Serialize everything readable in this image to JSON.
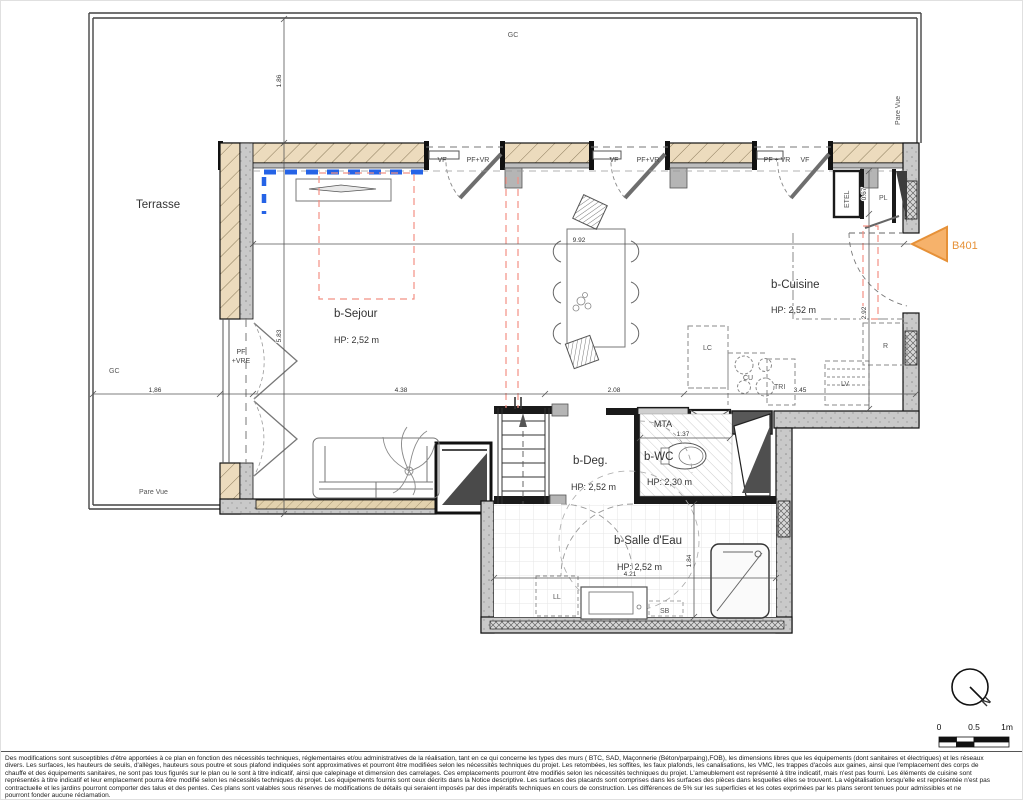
{
  "plan": {
    "terrace": {
      "label": "Terrasse",
      "gc_top": "GC",
      "gc_left": "GC",
      "pare_vue_bottom": "Pare Vue",
      "pare_vue_right": "Pare Vue"
    },
    "unit": {
      "label": "B401"
    },
    "rooms": {
      "sejour": {
        "name": "b-Sejour",
        "hp": "HP: 2,52 m"
      },
      "cuisine": {
        "name": "b-Cuisine",
        "hp": "HP: 2,52 m"
      },
      "deg": {
        "name": "b-Deg.",
        "hp": "HP: 2,52 m"
      },
      "wc": {
        "name": "b-WC",
        "hp": "HP: 2,30 m"
      },
      "salle_eau": {
        "name": "b-Salle d'Eau",
        "hp": "HP: 2,52 m"
      }
    },
    "openings": {
      "vf": "VF",
      "pf_vr": "PF+VR",
      "pf_vr_spaced": "PF + VR",
      "pf": "PF",
      "vre": "+VRE"
    },
    "equipment": {
      "etel": "ETEL",
      "pl": "PL",
      "lc": "LC",
      "cu": "CU",
      "tri": "TRI",
      "lv": "LV",
      "r": "R",
      "mta": "MTA",
      "ll": "LL",
      "sb": "SB"
    },
    "dims": {
      "w992": "9.92",
      "w438": "4.38",
      "w208": "2.08",
      "w345": "3.45",
      "w186": "1,86",
      "h186": "1.86",
      "h583": "5.83",
      "h067": "0.67",
      "h292": "2.92",
      "w137": "1.37",
      "h184": "1.84",
      "w421": "4.21"
    },
    "compass": {
      "north": "N"
    },
    "scale": {
      "zero": "0",
      "half": "0.5",
      "one": "1m"
    },
    "colors": {
      "accent_orange": "#e69138",
      "blue_dash": "#2563e6",
      "pink_dash": "#f08878",
      "wall_beige": "#ecdbbd"
    }
  },
  "disclaimer": {
    "l1": "Des modifications sont susceptibles d'être apportées à ce plan en fonction des nécessités techniques, réglementaires et/ou administratives de la réalisation, tant en ce qui concerne les types des murs ( BTC, SAD, Maçonnerie (Béton/parpaing),FOB), les dimensions libres que les équipements (dont sanitaires et électriques) et les réseaux",
    "l2": "divers. Les surfaces, les hauteurs de seuils, d'allèges, hauteurs sous poutre et sous plafond indiquées sont approximatives et pourront être modifiées selon les nécessités techniques du projet. Les retombées, les soffites, les faux plafonds, les canalisations, les VMC, les trappes d'accès aux gaines, ainsi que l'emplacement des corps de",
    "l3": "chauffe et des équipements sanitaires, ne sont pas tous figurés sur le plan ou le sont à titre indicatif, ainsi que calepinage et dimension des carrelages. Ces emplacements pourront être modifiés selon les nécessités techniques du projet. L'ameublement est représenté à titre indicatif, mais n'est pas fourni. Les éléments de cuisine sont",
    "l4": "représentés à titre indicatif et leur emplacement pourra être modifié selon les nécessités techniques du projet. Les équipements fournis sont ceux décrits dans la Notice descriptive. Les surfaces des placards sont comprises dans les surfaces des pièces dans lesquelles elles se trouvent. La végétalisation lorsqu'elle est représentée n'est pas",
    "l5": "contractuelle et les jardins pourront comporter des talus et des pentes. Ces plans sont valables sous réserves de modifications de détails qui seraient imposés par des impératifs techniques en cours de construction. Les différences de 5% sur les superficies et les cotes exprimées par les plans seront tenues pour admissibles et ne",
    "l6": "pourront fonder aucune réclamation."
  }
}
